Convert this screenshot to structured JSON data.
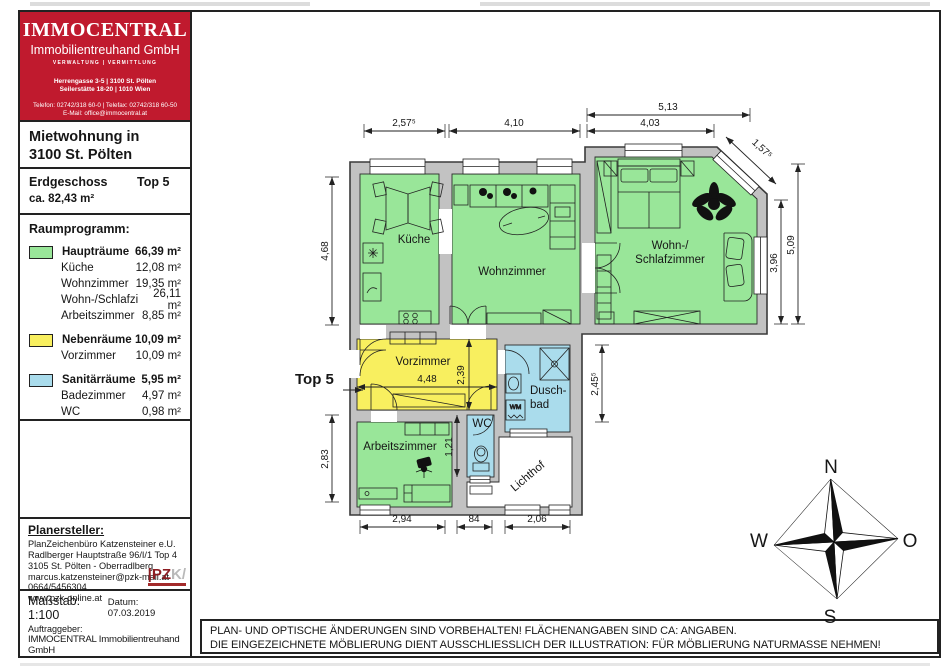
{
  "logo": {
    "name": "IMMOCENTRAL",
    "subname": "Immobilientreuhand GmbH",
    "tagline": "VERWALTUNG | VERMITTLUNG",
    "address1": "Herrengasse 3-5 | 3100 St. Pölten",
    "address2": "Seilerstätte 18-20 | 1010 Wien",
    "phone": "Telefon: 02742/318 60-0 | Telefax: 02742/318 60-50",
    "email": "E-Mail: office@immocentral.at"
  },
  "title": {
    "line1": "Mietwohnung in",
    "line2": "3100 St. Pölten"
  },
  "subtitle": {
    "floor": "Erdgeschoss",
    "unit": "Top 5",
    "area": "ca. 82,43 m²"
  },
  "legend": {
    "heading": "Raumprogramm:",
    "groups": [
      {
        "name": "Haupträume",
        "area": "66,39 m²",
        "color": "#99e699",
        "rooms": [
          {
            "name": "Küche",
            "area": "12,08 m²"
          },
          {
            "name": "Wohnzimmer",
            "area": "19,35 m²"
          },
          {
            "name": "Wohn-/Schlafzi",
            "area": "26,11 m²"
          },
          {
            "name": "Arbeitszimmer",
            "area": "8,85 m²"
          }
        ]
      },
      {
        "name": "Nebenräume",
        "area": "10,09 m²",
        "color": "#f8ef5f",
        "rooms": [
          {
            "name": "Vorzimmer",
            "area": "10,09 m²"
          }
        ]
      },
      {
        "name": "Sanitärräume",
        "area": "5,95 m²",
        "color": "#aadcec",
        "rooms": [
          {
            "name": "Badezimmer",
            "area": "4,97 m²"
          },
          {
            "name": "WC",
            "area": "0,98 m²"
          }
        ]
      }
    ]
  },
  "planner": {
    "heading": "Planersteller:",
    "lines": [
      "PlanZeichenbüro Katzensteiner e.U.",
      "Radlberger Hauptstraße 96/I/1 Top 4",
      "3105 St. Pölten - Oberradlberg",
      "marcus.katzensteiner@pzk-mail.at",
      "0664/5456304",
      "www.pzk-online.at"
    ],
    "logo_left": "|PZ",
    "logo_right": "K/"
  },
  "scalebox": {
    "scale": "Maßstab: 1:100",
    "date": "Datum: 07.03.2019",
    "client_label": "Auftraggeber:",
    "client": "IMMOCENTRAL Immobilientreuhand GmbH"
  },
  "disclaimer": {
    "line1": "PLAN- UND OPTISCHE ÄNDERUNGEN SIND VORBEHALTEN! FLÄCHENANGABEN SIND CA: ANGABEN.",
    "line2": "DIE EINGEZEICHNETE MÖBLIERUNG DIENT AUSSCHLIESSLICH DER ILLUSTRATION: FÜR MÖBLIERUNG NATURMASSE NEHMEN!"
  },
  "plan": {
    "unit_label": "Top 5",
    "wm_label": "WM",
    "rooms": [
      {
        "id": "kueche",
        "label": "Küche"
      },
      {
        "id": "wohnzimmer",
        "label": "Wohnzimmer"
      },
      {
        "id": "wohn-schlafzimmer",
        "label1": "Wohn-/",
        "label2": "Schlafzimmer"
      },
      {
        "id": "vorzimmer",
        "label": "Vorzimmer"
      },
      {
        "id": "wc",
        "label": "WC"
      },
      {
        "id": "duschbad",
        "label1": "Dusch-",
        "label2": "bad"
      },
      {
        "id": "arbeitszimmer",
        "label": "Arbeitszimmer"
      },
      {
        "id": "lichthof",
        "label": "Lichthof"
      }
    ],
    "dims": {
      "top1": "2,57⁵",
      "top2": "4,10",
      "top3": "5,13",
      "top4": "4,03",
      "diag": "1,57⁵",
      "left1": "4,68",
      "left2": "2,83",
      "right1": "3,96",
      "right2": "5,09",
      "bath": "2,45⁵",
      "hall_w": "4,48",
      "hall_h": "2,39",
      "wc_h": "1,21",
      "bot1": "2,94",
      "bot2": "84",
      "bot3": "2,06"
    }
  },
  "compass": {
    "north": "N",
    "south": "S",
    "west": "W",
    "east": "O"
  },
  "colors": {
    "hauptraeume": "#99e699",
    "nebenraeume": "#f8ef5f",
    "sanitaerraeume": "#aadcec",
    "walls": "#c2c2c2",
    "brand_red": "#c01a2e"
  }
}
